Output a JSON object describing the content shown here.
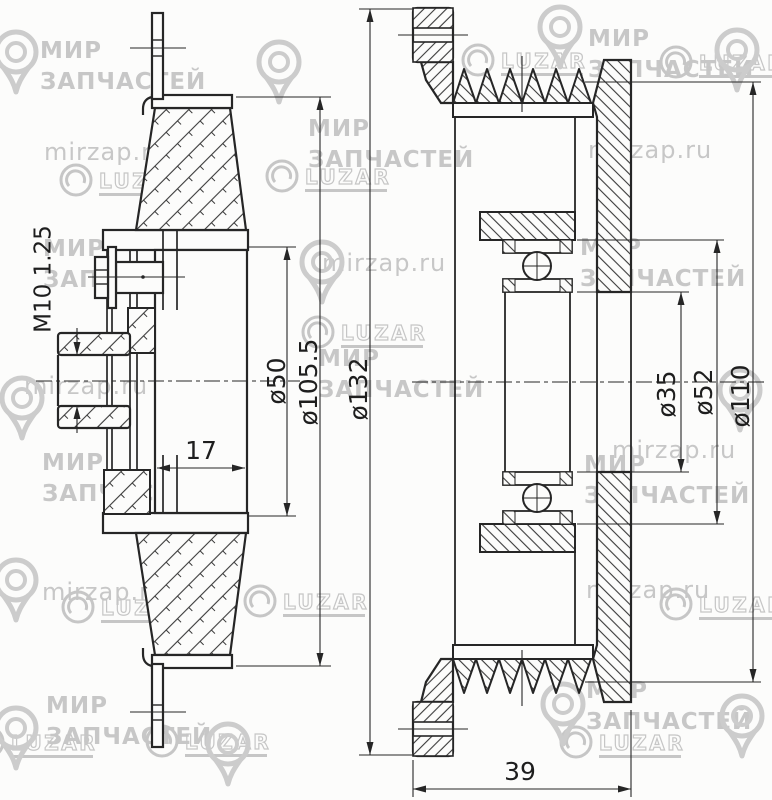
{
  "drawing": {
    "type": "technical-drawing",
    "subject": "pulley-cross-section-two-views",
    "colors": {
      "line": "#262626",
      "background": "#fcfcfb",
      "watermark": "#c7c7c7"
    },
    "dimensions": {
      "left_view": {
        "thread": "M10 1.25",
        "hub_width": "17",
        "d50": "ø50",
        "d105": "ø105.5",
        "d132": "ø132"
      },
      "right_view": {
        "d35": "ø35",
        "d52": "ø52",
        "d110": "ø110",
        "overall_width": "39"
      }
    },
    "watermarks": {
      "brand_line1": "МИР",
      "brand_line2": "ЗАПЧАСТЕЙ",
      "site": "mirzap.ru",
      "logo": "LUZAR"
    }
  }
}
